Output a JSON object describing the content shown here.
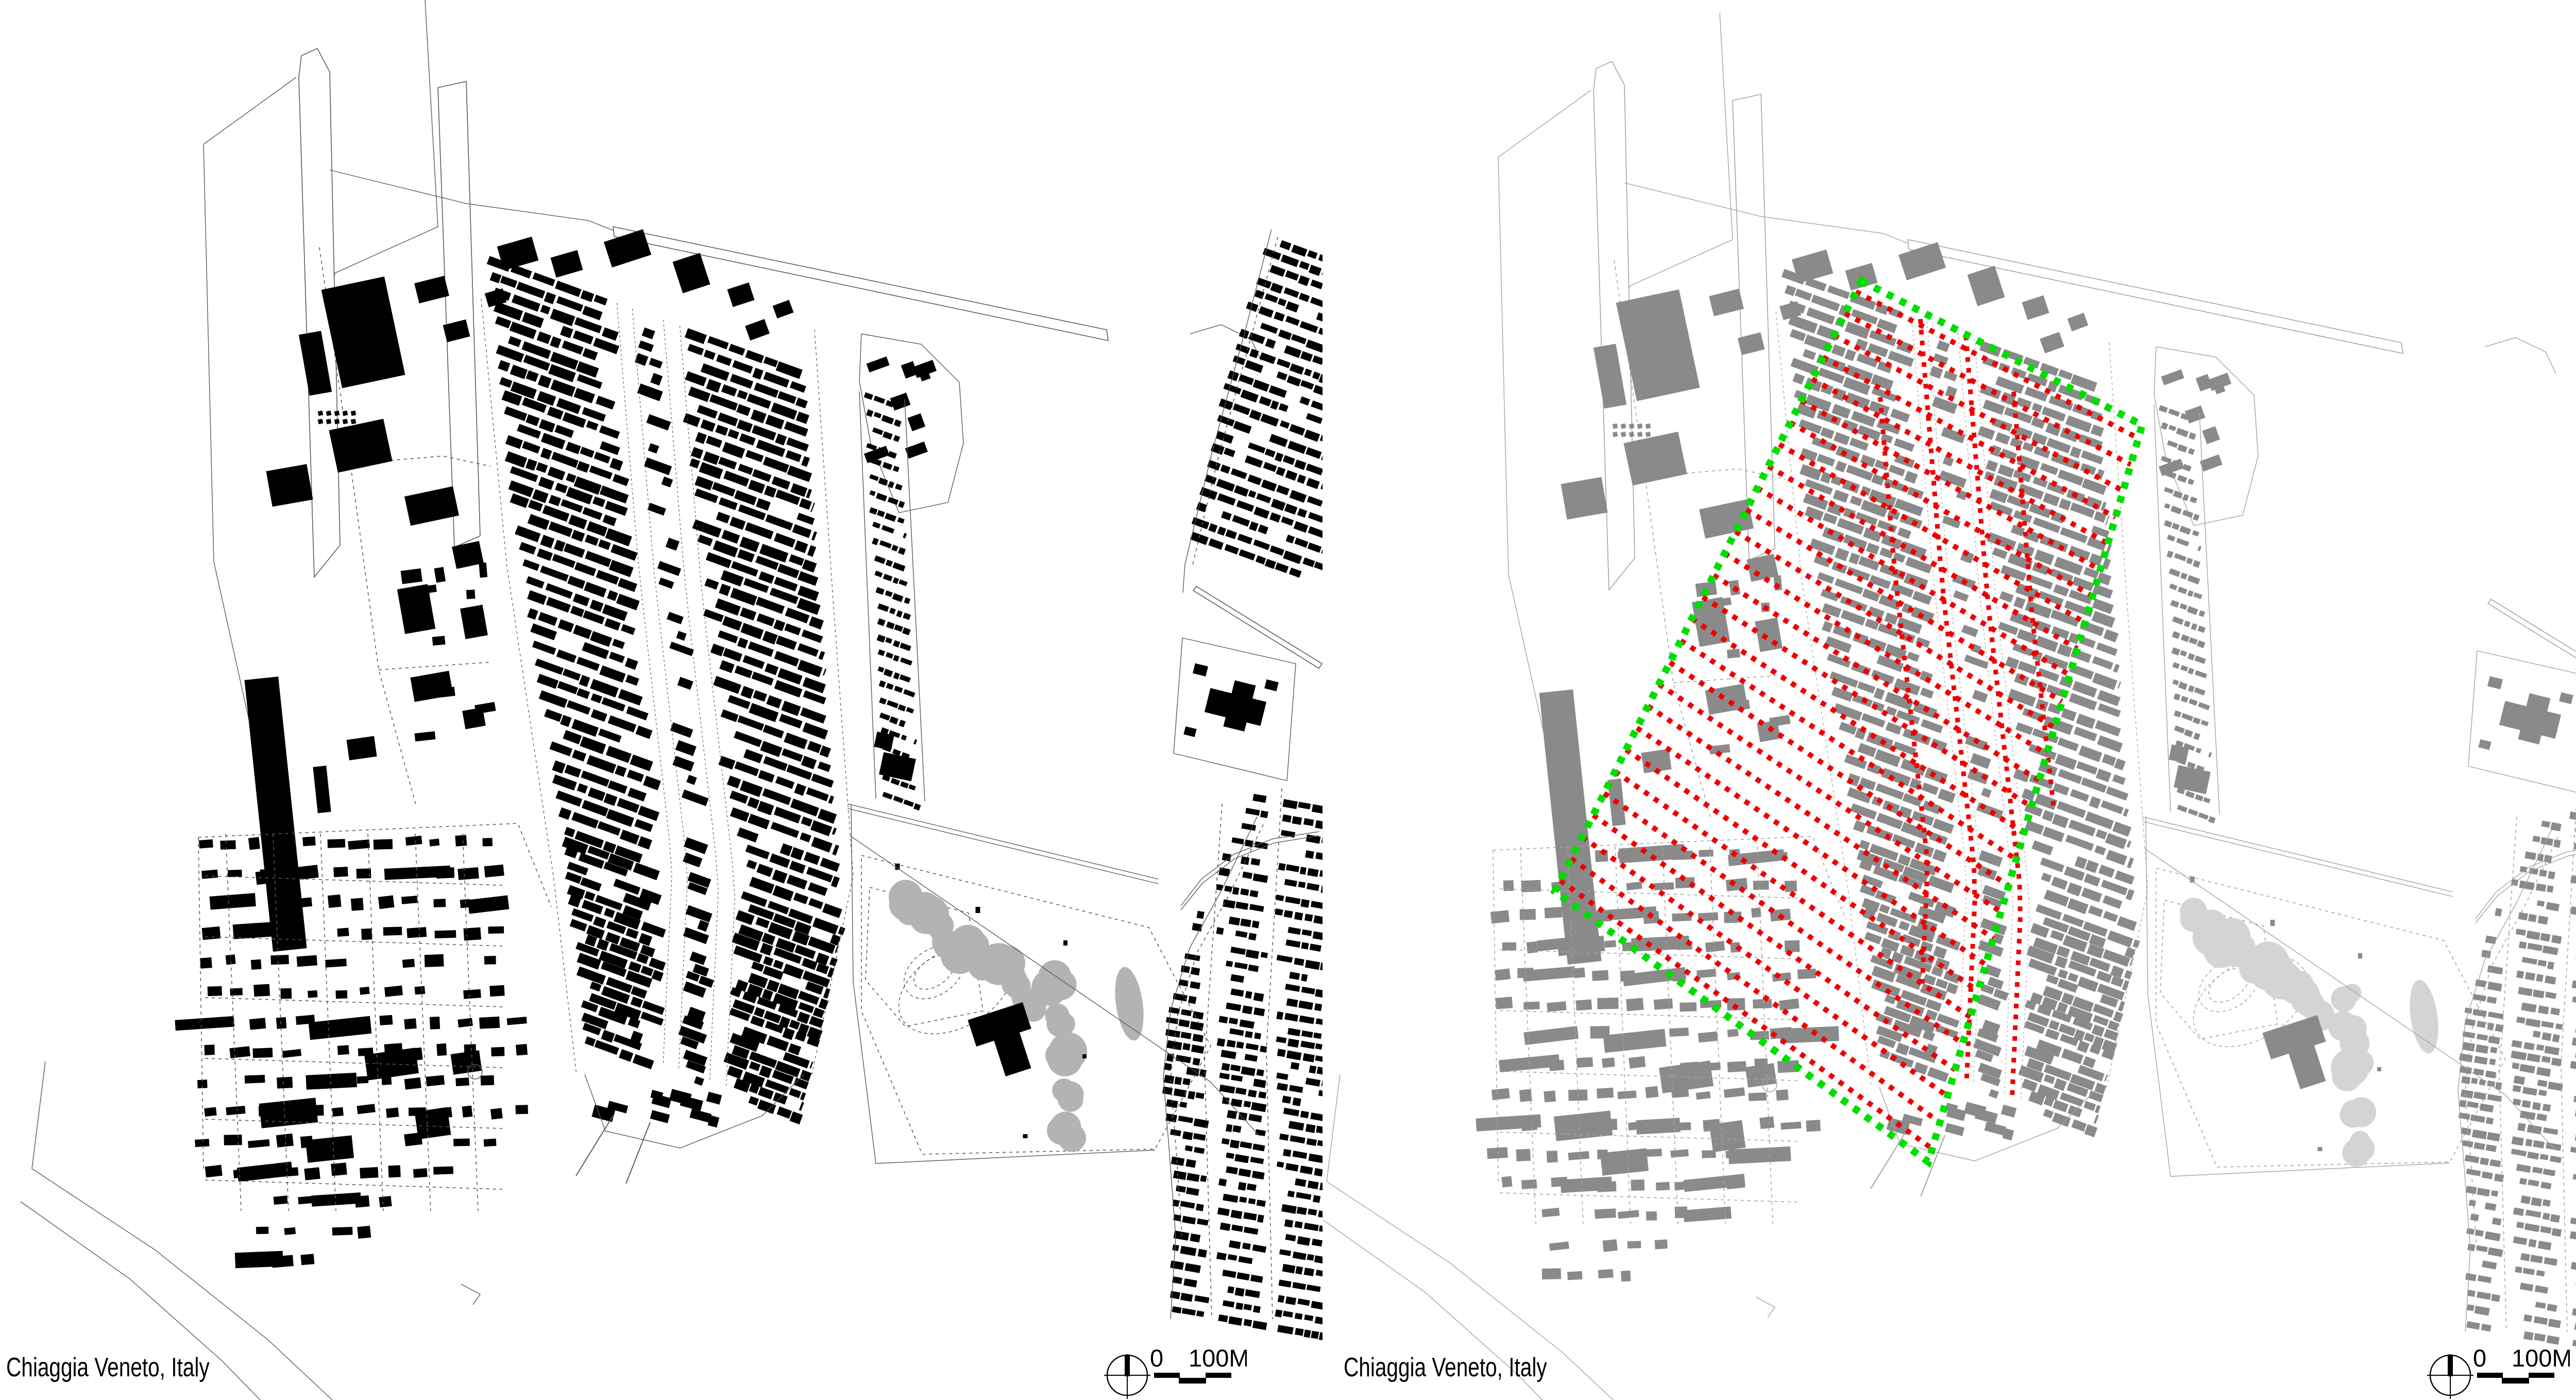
{
  "figure": {
    "type": "urban figure-ground map comparison",
    "location_label": "Chiaggia Veneto, Italy"
  },
  "panels": [
    {
      "id": "figure-ground-existing",
      "caption": "Chiaggia Veneto, Italy",
      "scale": {
        "zero_label": "0",
        "distance_label": "100M"
      },
      "style": {
        "background": "#ffffff",
        "building_color": "#000000",
        "line_color": "#5a5a5a",
        "tree_color": "#b3b3b3",
        "overlays": false
      }
    },
    {
      "id": "figure-ground-highlighted",
      "caption": "Chiaggia Veneto, Italy",
      "scale": {
        "zero_label": "0",
        "distance_label": "100M"
      },
      "style": {
        "background": "#ffffff",
        "building_color": "#8a8a8a",
        "line_color": "#a3a3a3",
        "tree_color": "#d4d4d4",
        "overlays": true,
        "street_overlay_color": "#ee0000",
        "boundary_overlay_color": "#00dd00"
      }
    }
  ]
}
